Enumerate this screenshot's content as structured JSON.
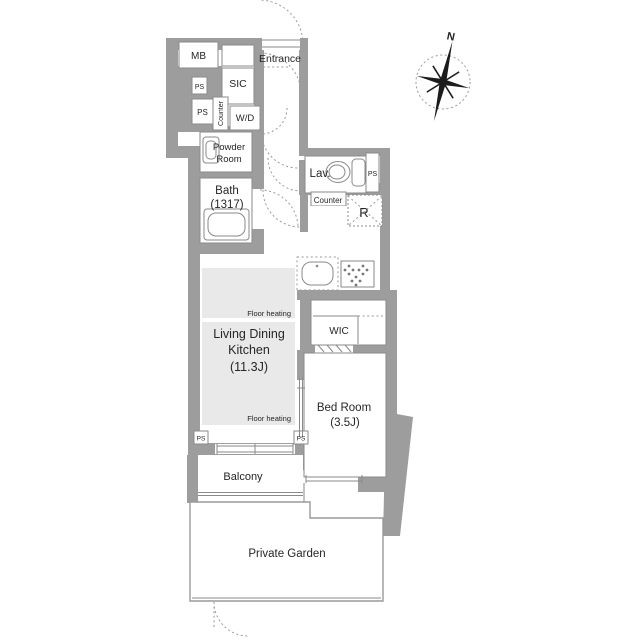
{
  "plan": {
    "compass": {
      "north": "N"
    },
    "labels": {
      "mb": "MB",
      "ps": "PS",
      "sic": "SIC",
      "entrance": "Entrance",
      "counter": "Counter",
      "wd": "W/D",
      "powder1": "Powder",
      "powder2": "Room",
      "bath1": "Bath",
      "bath2": "(1317)",
      "lav": "Lav.",
      "fridge": "R",
      "ldk1": "Living Dining",
      "ldk2": "Kitchen",
      "ldk3": "(11.3J)",
      "floor_heating": "Floor heating",
      "wic": "WIC",
      "bed1": "Bed Room",
      "bed2": "(3.5J)",
      "balcony": "Balcony",
      "garden": "Private Garden"
    },
    "colors": {
      "wall": "#9d9d9d",
      "floor_heating_fill": "#e9e9e9",
      "room_fill": "#ffffff",
      "line": "#8a8a8a",
      "text": "#262626"
    }
  }
}
